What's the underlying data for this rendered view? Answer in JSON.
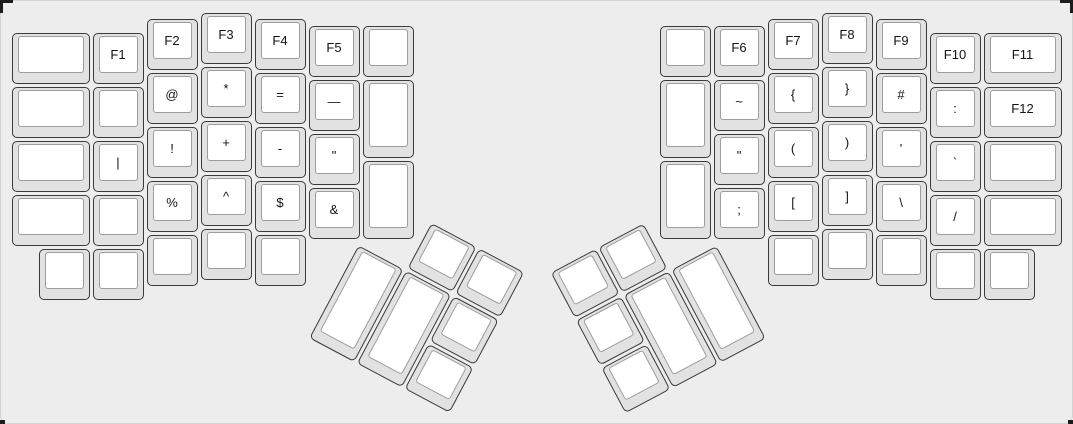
{
  "app": {
    "description": "ErgoDox split keyboard layout (function / symbol layer) rendered on a layout-editor canvas"
  },
  "colors": {
    "panel_bg": "#ededed",
    "panel_border": "#d2d2d2",
    "key_side": "#e2e2e2",
    "key_border": "#3a3a3a",
    "key_top": "#ffffff",
    "key_top_border": "#9d9d9d",
    "label_color": "#141414",
    "corner_mark": "#1c1c1c"
  },
  "keyboard": {
    "unit_px": 54,
    "key_count": 76,
    "groups": [
      {
        "id": "left-main",
        "name": "left-half-main",
        "origin_x": 10,
        "origin_y": 11,
        "rotation_deg": 0,
        "keys": [
          {
            "x": 0,
            "y": 0.375,
            "w": 1.5,
            "h": 1,
            "label": "",
            "name": "key-blank"
          },
          {
            "x": 1.5,
            "y": 0.375,
            "w": 1,
            "h": 1,
            "label": "F1",
            "name": "key-f1"
          },
          {
            "x": 2.5,
            "y": 0.125,
            "w": 1,
            "h": 1,
            "label": "F2",
            "name": "key-f2"
          },
          {
            "x": 3.5,
            "y": 0,
            "w": 1,
            "h": 1,
            "label": "F3",
            "name": "key-f3"
          },
          {
            "x": 4.5,
            "y": 0.125,
            "w": 1,
            "h": 1,
            "label": "F4",
            "name": "key-f4"
          },
          {
            "x": 5.5,
            "y": 0.25,
            "w": 1,
            "h": 1,
            "label": "F5",
            "name": "key-f5"
          },
          {
            "x": 6.5,
            "y": 0.25,
            "w": 1,
            "h": 1,
            "label": "",
            "name": "key-blank"
          },
          {
            "x": 0,
            "y": 1.375,
            "w": 1.5,
            "h": 1,
            "label": "",
            "name": "key-blank"
          },
          {
            "x": 1.5,
            "y": 1.375,
            "w": 1,
            "h": 1,
            "label": "",
            "name": "key-blank"
          },
          {
            "x": 2.5,
            "y": 1.125,
            "w": 1,
            "h": 1,
            "label": "@",
            "name": "key-at"
          },
          {
            "x": 3.5,
            "y": 1,
            "w": 1,
            "h": 1,
            "label": "*",
            "name": "key-asterisk"
          },
          {
            "x": 4.5,
            "y": 1.125,
            "w": 1,
            "h": 1,
            "label": "=",
            "name": "key-equals"
          },
          {
            "x": 5.5,
            "y": 1.25,
            "w": 1,
            "h": 1,
            "label": "—",
            "name": "key-dash"
          },
          {
            "x": 6.5,
            "y": 1.25,
            "w": 1,
            "h": 1.5,
            "label": "",
            "name": "key-blank-tall"
          },
          {
            "x": 0,
            "y": 2.375,
            "w": 1.5,
            "h": 1,
            "label": "",
            "name": "key-blank"
          },
          {
            "x": 1.5,
            "y": 2.375,
            "w": 1,
            "h": 1,
            "label": "|",
            "name": "key-pipe"
          },
          {
            "x": 2.5,
            "y": 2.125,
            "w": 1,
            "h": 1,
            "label": "!",
            "name": "key-exclamation"
          },
          {
            "x": 3.5,
            "y": 2,
            "w": 1,
            "h": 1,
            "label": "+",
            "name": "key-plus"
          },
          {
            "x": 4.5,
            "y": 2.125,
            "w": 1,
            "h": 1,
            "label": "-",
            "name": "key-minus"
          },
          {
            "x": 5.5,
            "y": 2.25,
            "w": 1,
            "h": 1,
            "label": "\"",
            "name": "key-double-quote"
          },
          {
            "x": 0,
            "y": 3.375,
            "w": 1.5,
            "h": 1,
            "label": "",
            "name": "key-blank"
          },
          {
            "x": 1.5,
            "y": 3.375,
            "w": 1,
            "h": 1,
            "label": "",
            "name": "key-blank"
          },
          {
            "x": 2.5,
            "y": 3.125,
            "w": 1,
            "h": 1,
            "label": "%",
            "name": "key-percent"
          },
          {
            "x": 3.5,
            "y": 3,
            "w": 1,
            "h": 1,
            "label": "^",
            "name": "key-caret"
          },
          {
            "x": 4.5,
            "y": 3.125,
            "w": 1,
            "h": 1,
            "label": "$",
            "name": "key-dollar"
          },
          {
            "x": 5.5,
            "y": 3.25,
            "w": 1,
            "h": 1,
            "label": "&",
            "name": "key-ampersand"
          },
          {
            "x": 6.5,
            "y": 2.75,
            "w": 1,
            "h": 1.5,
            "label": "",
            "name": "key-blank-tall"
          },
          {
            "x": 0.5,
            "y": 4.375,
            "w": 1,
            "h": 1,
            "label": "",
            "name": "key-blank"
          },
          {
            "x": 1.5,
            "y": 4.375,
            "w": 1,
            "h": 1,
            "label": "",
            "name": "key-blank"
          },
          {
            "x": 2.5,
            "y": 4.125,
            "w": 1,
            "h": 1,
            "label": "",
            "name": "key-blank"
          },
          {
            "x": 3.5,
            "y": 4,
            "w": 1,
            "h": 1,
            "label": "",
            "name": "key-blank"
          },
          {
            "x": 4.5,
            "y": 4.125,
            "w": 1,
            "h": 1,
            "label": "",
            "name": "key-blank"
          }
        ]
      },
      {
        "id": "right-main",
        "name": "right-half-main",
        "origin_x": 658,
        "origin_y": 11,
        "rotation_deg": 0,
        "keys": [
          {
            "x": 0,
            "y": 0.25,
            "w": 1,
            "h": 1,
            "label": "",
            "name": "key-blank"
          },
          {
            "x": 1,
            "y": 0.25,
            "w": 1,
            "h": 1,
            "label": "F6",
            "name": "key-f6"
          },
          {
            "x": 2,
            "y": 0.125,
            "w": 1,
            "h": 1,
            "label": "F7",
            "name": "key-f7"
          },
          {
            "x": 3,
            "y": 0,
            "w": 1,
            "h": 1,
            "label": "F8",
            "name": "key-f8"
          },
          {
            "x": 4,
            "y": 0.125,
            "w": 1,
            "h": 1,
            "label": "F9",
            "name": "key-f9"
          },
          {
            "x": 5,
            "y": 0.375,
            "w": 1,
            "h": 1,
            "label": "F10",
            "name": "key-f10"
          },
          {
            "x": 6,
            "y": 0.375,
            "w": 1.5,
            "h": 1,
            "label": "F11",
            "name": "key-f11"
          },
          {
            "x": 0,
            "y": 1.25,
            "w": 1,
            "h": 1.5,
            "label": "",
            "name": "key-blank-tall"
          },
          {
            "x": 1,
            "y": 1.25,
            "w": 1,
            "h": 1,
            "label": "~",
            "name": "key-tilde"
          },
          {
            "x": 2,
            "y": 1.125,
            "w": 1,
            "h": 1,
            "label": "{",
            "name": "key-brace-open"
          },
          {
            "x": 3,
            "y": 1,
            "w": 1,
            "h": 1,
            "label": "}",
            "name": "key-brace-close"
          },
          {
            "x": 4,
            "y": 1.125,
            "w": 1,
            "h": 1,
            "label": "#",
            "name": "key-hash"
          },
          {
            "x": 5,
            "y": 1.375,
            "w": 1,
            "h": 1,
            "label": ":",
            "name": "key-colon"
          },
          {
            "x": 6,
            "y": 1.375,
            "w": 1.5,
            "h": 1,
            "label": "F12",
            "name": "key-f12"
          },
          {
            "x": 1,
            "y": 2.25,
            "w": 1,
            "h": 1,
            "label": "\"",
            "name": "key-double-quote"
          },
          {
            "x": 2,
            "y": 2.125,
            "w": 1,
            "h": 1,
            "label": "(",
            "name": "key-paren-open"
          },
          {
            "x": 3,
            "y": 2,
            "w": 1,
            "h": 1,
            "label": ")",
            "name": "key-paren-close"
          },
          {
            "x": 4,
            "y": 2.125,
            "w": 1,
            "h": 1,
            "label": "'",
            "name": "key-quote"
          },
          {
            "x": 5,
            "y": 2.375,
            "w": 1,
            "h": 1,
            "label": "`",
            "name": "key-backtick"
          },
          {
            "x": 6,
            "y": 2.375,
            "w": 1.5,
            "h": 1,
            "label": "",
            "name": "key-blank"
          },
          {
            "x": 0,
            "y": 2.75,
            "w": 1,
            "h": 1.5,
            "label": "",
            "name": "key-blank-tall"
          },
          {
            "x": 1,
            "y": 3.25,
            "w": 1,
            "h": 1,
            "label": ";",
            "name": "key-semicolon"
          },
          {
            "x": 2,
            "y": 3.125,
            "w": 1,
            "h": 1,
            "label": "[",
            "name": "key-bracket-open"
          },
          {
            "x": 3,
            "y": 3,
            "w": 1,
            "h": 1,
            "label": "]",
            "name": "key-bracket-close"
          },
          {
            "x": 4,
            "y": 3.125,
            "w": 1,
            "h": 1,
            "label": "\\",
            "name": "key-backslash"
          },
          {
            "x": 5,
            "y": 3.375,
            "w": 1,
            "h": 1,
            "label": "/",
            "name": "key-slash"
          },
          {
            "x": 6,
            "y": 3.375,
            "w": 1.5,
            "h": 1,
            "label": "",
            "name": "key-blank"
          },
          {
            "x": 2,
            "y": 4.125,
            "w": 1,
            "h": 1,
            "label": "",
            "name": "key-blank"
          },
          {
            "x": 3,
            "y": 4,
            "w": 1,
            "h": 1,
            "label": "",
            "name": "key-blank"
          },
          {
            "x": 4,
            "y": 4.125,
            "w": 1,
            "h": 1,
            "label": "",
            "name": "key-blank"
          },
          {
            "x": 5,
            "y": 4.375,
            "w": 1,
            "h": 1,
            "label": "",
            "name": "key-blank"
          },
          {
            "x": 6,
            "y": 4.375,
            "w": 1,
            "h": 1,
            "label": "",
            "name": "key-blank"
          }
        ]
      },
      {
        "id": "left-thumb",
        "name": "left-thumb-cluster",
        "origin_x": 383,
        "origin_y": 195,
        "rotation_deg": 28,
        "keys": [
          {
            "x": 1,
            "y": 0,
            "w": 1,
            "h": 1,
            "label": "",
            "name": "key-blank-thumb"
          },
          {
            "x": 2,
            "y": 0,
            "w": 1,
            "h": 1,
            "label": "",
            "name": "key-blank-thumb"
          },
          {
            "x": 0,
            "y": 1,
            "w": 1,
            "h": 2,
            "label": "",
            "name": "key-blank-thumb-2u"
          },
          {
            "x": 1,
            "y": 1,
            "w": 1,
            "h": 2,
            "label": "",
            "name": "key-blank-thumb-2u"
          },
          {
            "x": 2,
            "y": 1,
            "w": 1,
            "h": 1,
            "label": "",
            "name": "key-blank-thumb"
          },
          {
            "x": 2,
            "y": 2,
            "w": 1,
            "h": 1,
            "label": "",
            "name": "key-blank-thumb"
          }
        ]
      },
      {
        "id": "right-thumb",
        "name": "right-thumb-cluster",
        "origin_x": 548,
        "origin_y": 272,
        "rotation_deg": -28,
        "keys": [
          {
            "x": 0,
            "y": 0,
            "w": 1,
            "h": 1,
            "label": "",
            "name": "key-blank-thumb"
          },
          {
            "x": 1,
            "y": 0,
            "w": 1,
            "h": 1,
            "label": "",
            "name": "key-blank-thumb"
          },
          {
            "x": 0,
            "y": 1,
            "w": 1,
            "h": 1,
            "label": "",
            "name": "key-blank-thumb"
          },
          {
            "x": 0,
            "y": 2,
            "w": 1,
            "h": 1,
            "label": "",
            "name": "key-blank-thumb"
          },
          {
            "x": 1,
            "y": 1,
            "w": 1,
            "h": 2,
            "label": "",
            "name": "key-blank-thumb-2u"
          },
          {
            "x": 2,
            "y": 1,
            "w": 1,
            "h": 2,
            "label": "",
            "name": "key-blank-thumb-2u"
          }
        ]
      }
    ]
  }
}
